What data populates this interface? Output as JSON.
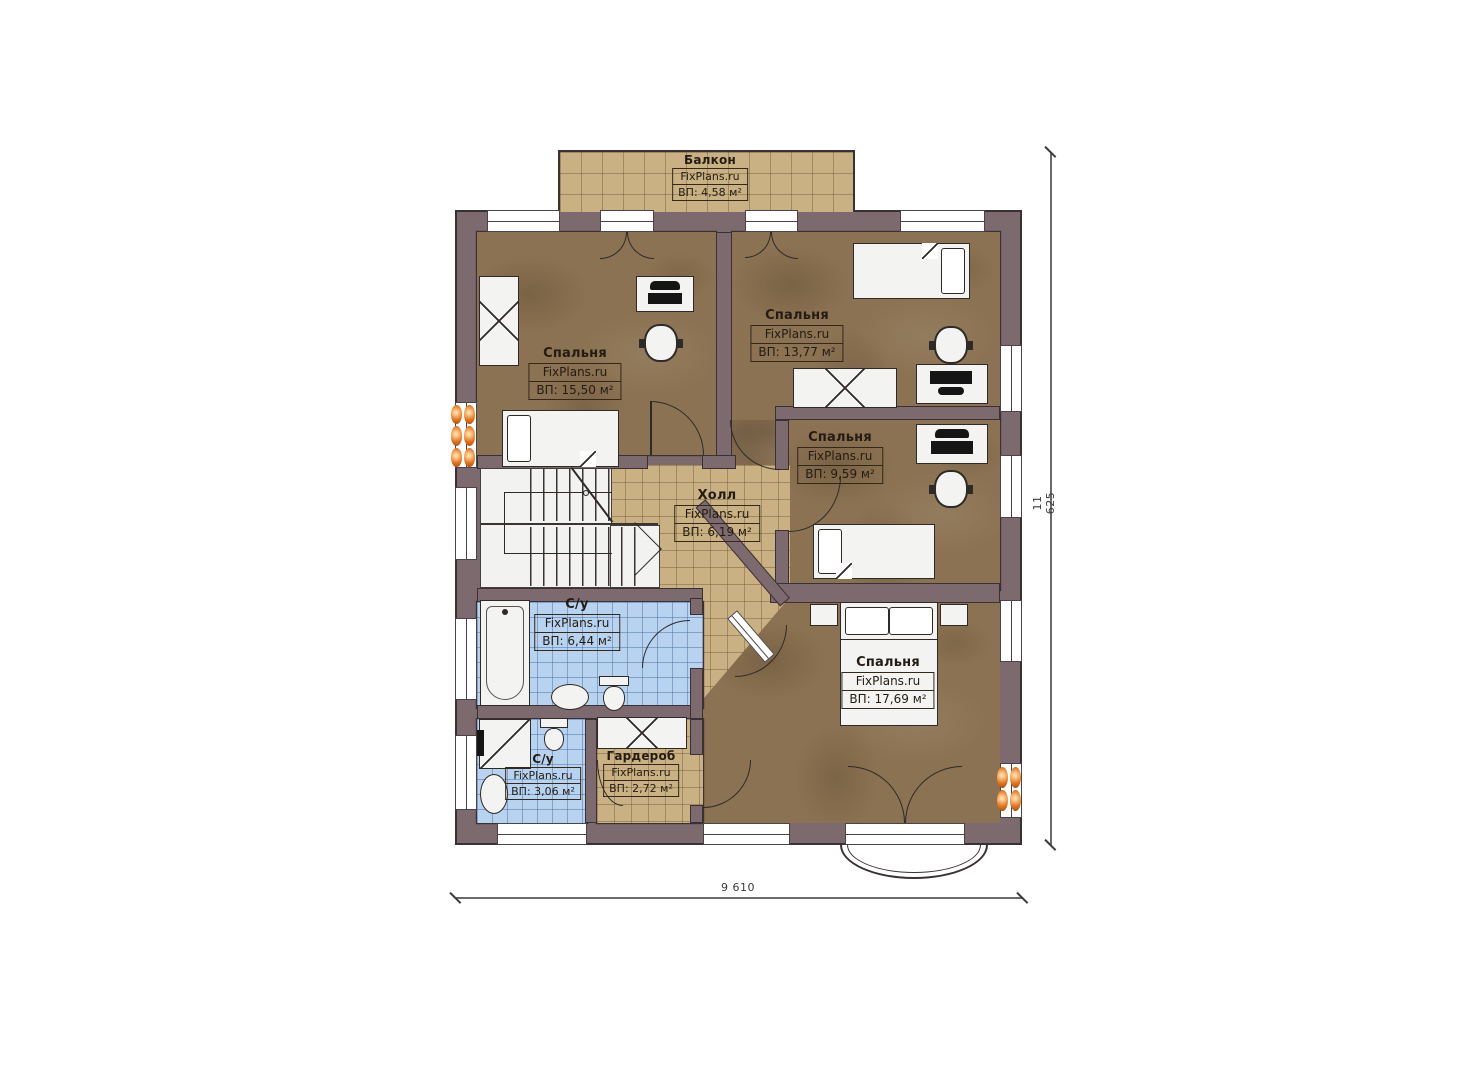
{
  "plan": {
    "brand": "FixPlans.ru",
    "rooms": [
      {
        "id": "balcony",
        "name": "Балкон",
        "brand": "FixPlans.ru",
        "area": "ВП: 4,58 м²"
      },
      {
        "id": "bedroom-left",
        "name": "Спальня",
        "brand": "FixPlans.ru",
        "area": "ВП: 15,50 м²"
      },
      {
        "id": "bedroom-top-right",
        "name": "Спальня",
        "brand": "FixPlans.ru",
        "area": "ВП: 13,77 м²"
      },
      {
        "id": "bedroom-mid-right",
        "name": "Спальня",
        "brand": "FixPlans.ru",
        "area": "ВП: 9,59 м²"
      },
      {
        "id": "hall",
        "name": "Холл",
        "brand": "FixPlans.ru",
        "area": "ВП: 6,19 м²"
      },
      {
        "id": "bathroom-main",
        "name": "С/у",
        "brand": "FixPlans.ru",
        "area": "ВП: 6,44 м²"
      },
      {
        "id": "bathroom-small",
        "name": "С/у",
        "brand": "FixPlans.ru",
        "area": "ВП: 3,06 м²"
      },
      {
        "id": "wardrobe-room",
        "name": "Гардероб",
        "brand": "FixPlans.ru",
        "area": "ВП: 2,72 м²"
      },
      {
        "id": "bedroom-master",
        "name": "Спальня",
        "brand": "FixPlans.ru",
        "area": "ВП: 17,69 м²"
      }
    ],
    "dimensions": {
      "width_label": "9 610",
      "height_label": "11 625"
    },
    "colors": {
      "wall": "#7d6a6e",
      "floor_wood": "#8b7252",
      "floor_tile_tan": "#c9b183",
      "floor_tile_blue": "#b8d3ef",
      "radiator": "#e6761e",
      "outline": "#3a3134"
    }
  }
}
